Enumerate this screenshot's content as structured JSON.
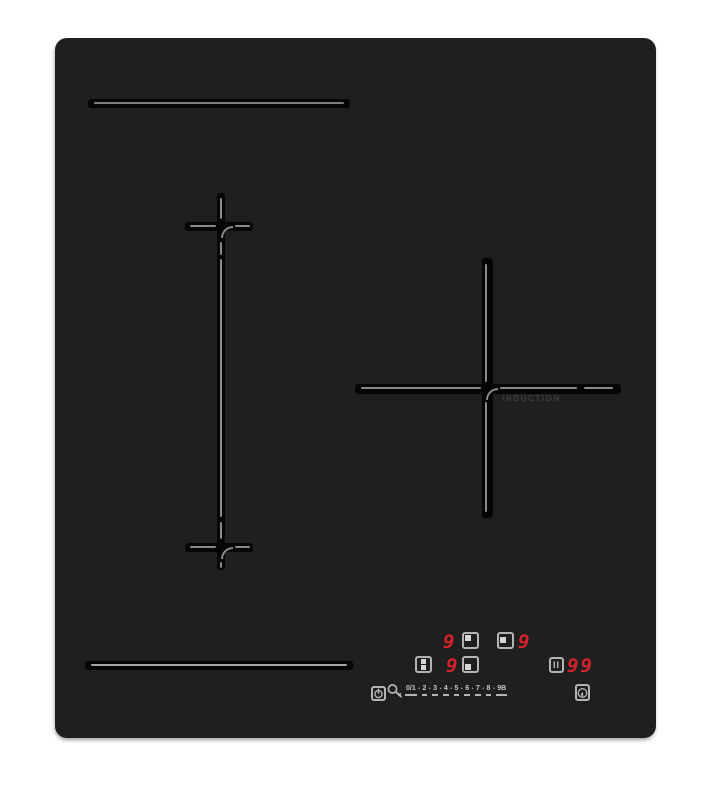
{
  "colors": {
    "background": "#ffffff",
    "surface": "#1f1f20",
    "groove": "#060606",
    "line_gray": "#8a8a8a",
    "icon_gray": "#b4b4b4",
    "accent_red": "#d2232a",
    "induction_text": "#3c3c3c"
  },
  "cooktop": {
    "zone_right_label": "INDUCTION",
    "displays": {
      "rear_left_level": "9",
      "right_level": "9",
      "front_left_level": "9",
      "timer": "99"
    },
    "controls": {
      "pause_label": "II",
      "separator": "•",
      "slider_levels": [
        "0/1",
        "2",
        "3",
        "4",
        "5",
        "6",
        "7",
        "8",
        "9B"
      ]
    }
  }
}
